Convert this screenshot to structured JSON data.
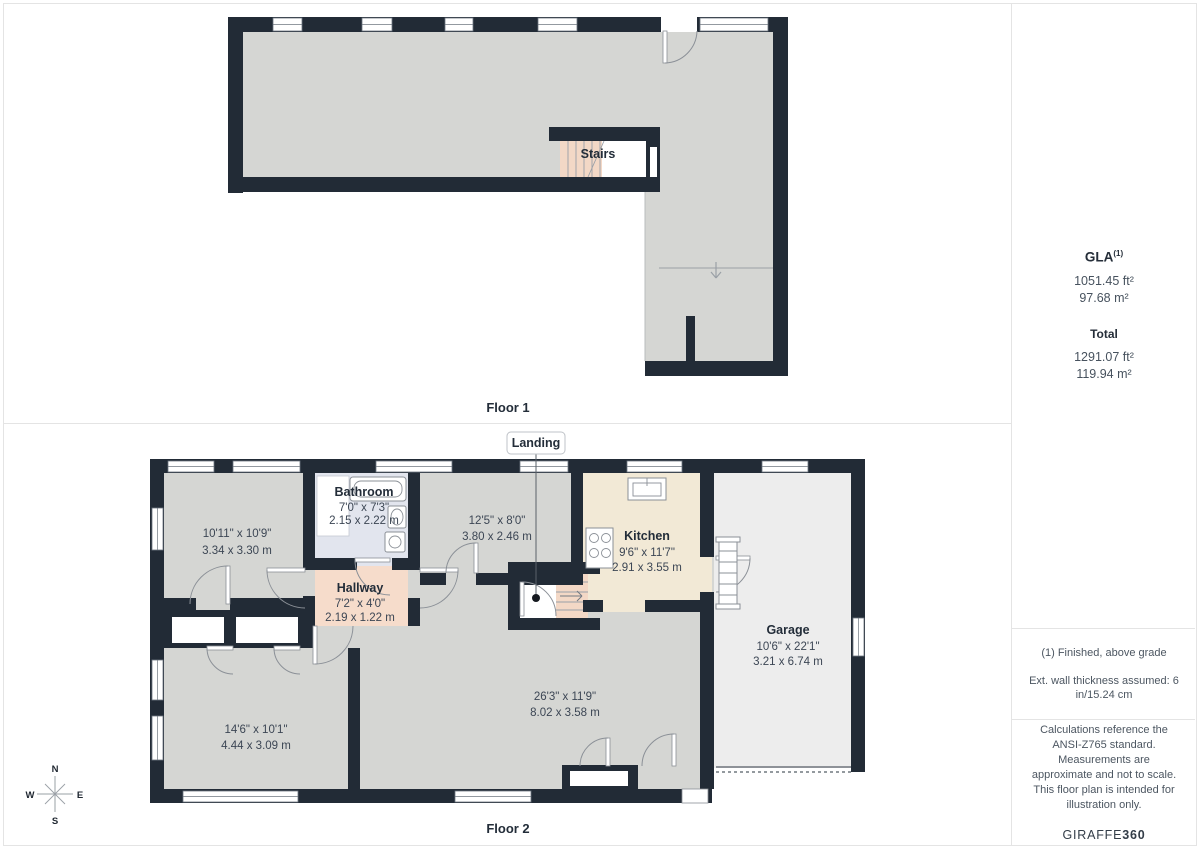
{
  "panel_floor1": {
    "title": "Floor 1",
    "stairs_label": "Stairs"
  },
  "panel_floor2": {
    "title": "Floor 2",
    "landing_label": "Landing",
    "rooms": [
      {
        "name": "",
        "dims_ft": "10'11\" x 10'9\"",
        "dims_m": "3.34 x 3.30 m"
      },
      {
        "name": "Bathroom",
        "dims_ft": "7'0\" x 7'3\"",
        "dims_m": "2.15 x 2.22 m"
      },
      {
        "name": "",
        "dims_ft": "12'5\" x 8'0\"",
        "dims_m": "3.80 x 2.46 m"
      },
      {
        "name": "Kitchen",
        "dims_ft": "9'6\" x 11'7\"",
        "dims_m": "2.91 x 3.55 m"
      },
      {
        "name": "Hallway",
        "dims_ft": "7'2\" x 4'0\"",
        "dims_m": "2.19 x 1.22 m"
      },
      {
        "name": "Garage",
        "dims_ft": "10'6\" x 22'1\"",
        "dims_m": "3.21 x 6.74 m"
      },
      {
        "name": "",
        "dims_ft": "14'6\" x 10'1\"",
        "dims_m": "4.44 x 3.09 m"
      },
      {
        "name": "",
        "dims_ft": "26'3\" x 11'9\"",
        "dims_m": "8.02 x 3.58 m"
      }
    ]
  },
  "sidebar": {
    "gla_label": "GLA",
    "gla_sup": "(1)",
    "gla_ft": "1051.45 ft²",
    "gla_m": "97.68 m²",
    "total_label": "Total",
    "total_ft": "1291.07 ft²",
    "total_m": "119.94 m²",
    "footnote": "(1) Finished, above grade",
    "wall_note": "Ext. wall thickness assumed: 6 in/15.24 cm",
    "disclaimer": "Calculations reference the ANSI-Z765 standard. Measurements are approximate and not to scale. This floor plan is intended for illustration only.",
    "brand_name": "GIRAFFE",
    "brand_suffix": "360"
  },
  "compass": {
    "n": "N",
    "e": "E",
    "s": "S",
    "w": "W"
  },
  "colors": {
    "wall": "#222b36",
    "floor_gray": "#d5d6d3",
    "garage_floor": "#ededed",
    "kitchen_floor": "#f2e9d6",
    "bathroom_floor": "#e2e5ee",
    "hallway_floor": "#f6dccb",
    "stairs_peach": "#f3d8c6",
    "divider": "#e4e4e4"
  }
}
